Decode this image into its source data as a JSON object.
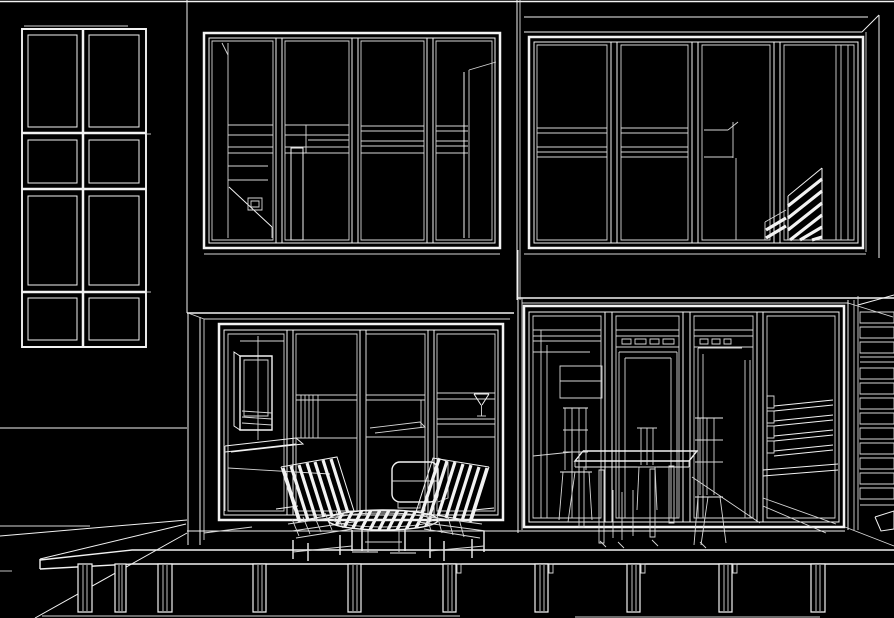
{
  "meta": {
    "domain": "Diagram",
    "drawing_type": "architectural-elevation-wireframe",
    "description": "Monochrome CAD wireframe elevation of a two-storey modular house: three glazed wall sections over a raised timber deck on round posts. Interior silhouettes show stairs, a wall-mounted TV with console, kitchen counter with a glass, a sofa, a dining table with ladder-back chairs, and slatted privacy screens. Two slatted patio chairs and a round slatted table sit on the deck."
  },
  "canvas": {
    "width": 894,
    "height": 618,
    "background_color": "#000000",
    "line_color": "#f2f2f2",
    "secondary_line_color": "#d6d6d6"
  },
  "scene": {
    "sections": [
      {
        "name": "left-wall",
        "elements": [
          "eight-pane-window"
        ]
      },
      {
        "name": "upper-middle-glazing",
        "elements": [
          "four-pane-curtain-wall",
          "interior-stair",
          "loft-edge",
          "interior-column"
        ]
      },
      {
        "name": "upper-right-glazing",
        "elements": [
          "four-pane-curtain-wall",
          "roof-fascia",
          "mid-rails",
          "stair-louver-screen"
        ]
      },
      {
        "name": "lower-middle-glazing",
        "elements": [
          "sliding-doors",
          "tv-unit",
          "media-console",
          "kitchen-counter",
          "glass-on-counter",
          "sofa"
        ]
      },
      {
        "name": "lower-right-glazing",
        "elements": [
          "sliding-doors",
          "clerestory-vents",
          "dining-table",
          "ladder-back-chairs",
          "interior-railing"
        ]
      },
      {
        "name": "right-louver-screen",
        "elements": [
          "horizontal-slats",
          "side-step"
        ]
      },
      {
        "name": "deck",
        "elements": [
          "deck-slab",
          "fascia-band",
          "ten-round-posts",
          "ground-line",
          "perspective-edges"
        ]
      },
      {
        "name": "patio-furniture",
        "elements": [
          "slatted-chair-left",
          "slatted-chair-right",
          "round-slatted-table"
        ]
      }
    ]
  }
}
